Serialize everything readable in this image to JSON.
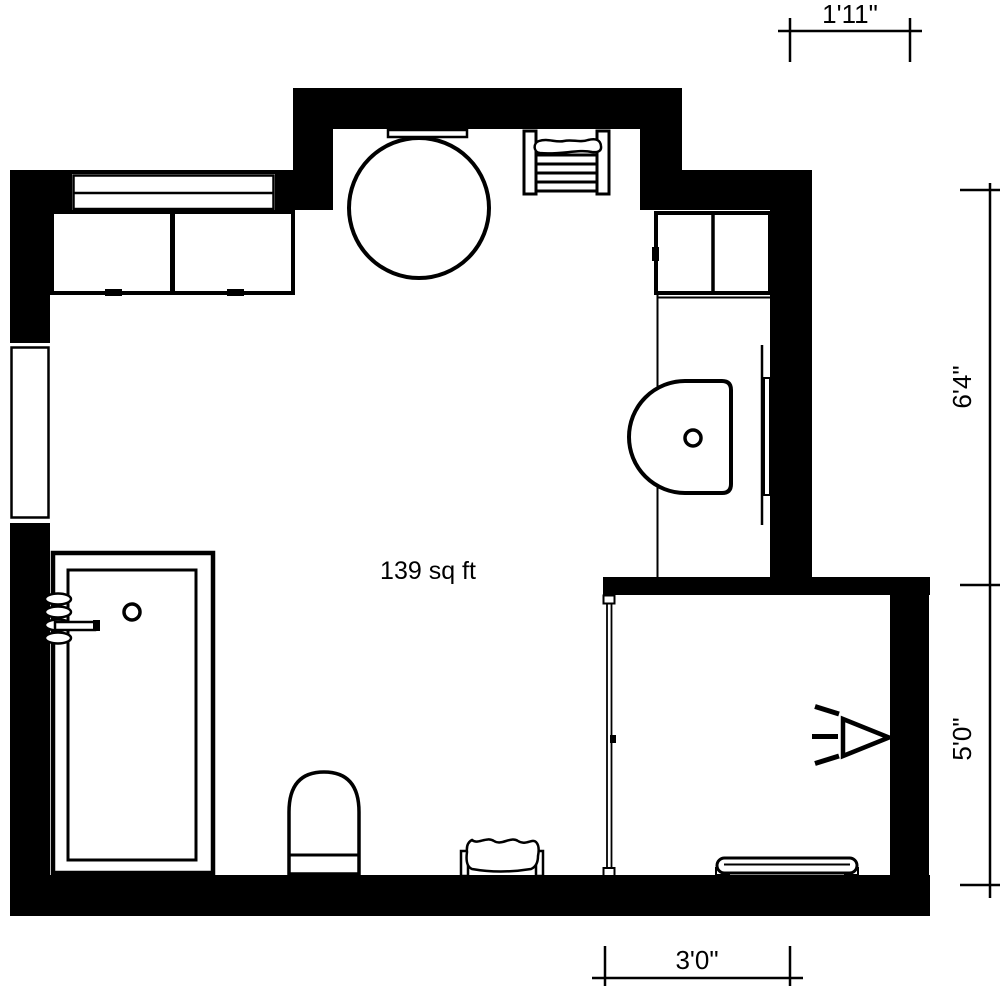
{
  "plan": {
    "area_label": "139 sq ft",
    "dimensions": {
      "top_width": "1'11\"",
      "right_upper_height": "6'4\"",
      "right_lower_height": "5'0\"",
      "bottom_width": "3'0\""
    },
    "colors": {
      "wall": "#000000",
      "floor": "#ffffff",
      "line": "#000000",
      "background": "#ffffff"
    },
    "fixtures": [
      "wall-cabinet-double",
      "wall-shelf",
      "round-table",
      "towel-radiator",
      "vanity-cabinet",
      "vanity-counter",
      "sink",
      "mirror",
      "bathtub",
      "bath-faucet",
      "stool",
      "laundry-basket",
      "window-top",
      "window-left",
      "shower-glass-door",
      "shower-head",
      "shower-mat"
    ]
  }
}
